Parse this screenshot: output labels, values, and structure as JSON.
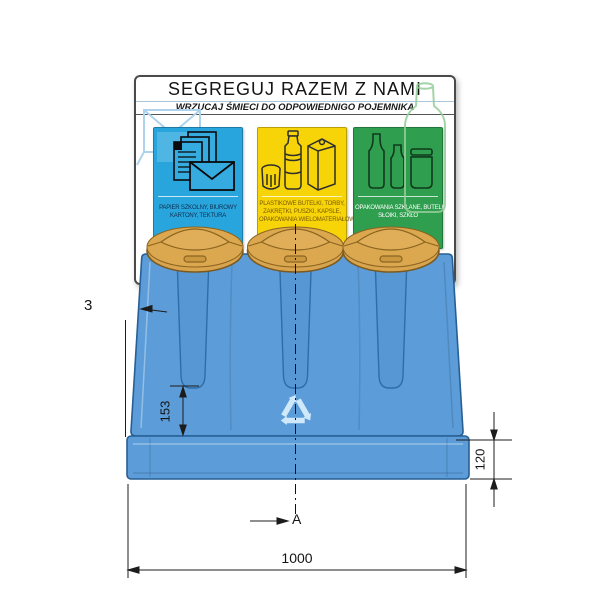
{
  "signboard": {
    "title": "SEGREGUJ RAZEM Z NAMI",
    "subtitle": "WRZUCAJ ŚMIECI DO ODPOWIEDNIGO POJEMNIKA",
    "panels": [
      {
        "name": "paper",
        "color": "#29a5dd",
        "icon": "paper-and-envelope-icon",
        "caption_lines": [
          "PAPIER SZKOLNY, BIUROWY",
          "KARTONY, TEKTURA"
        ]
      },
      {
        "name": "plastic",
        "color": "#f7d408",
        "icon": "plastic-bottle-can-carton-icon",
        "caption_lines": [
          "PLASTIKOWE BUTELKI, TORBY,",
          "ZAKRĘTKI, PUSZKI, KAPSLE,",
          "OPAKOWANIA WIELOMATERIAŁOWE"
        ]
      },
      {
        "name": "glass",
        "color": "#2f9e4f",
        "icon": "glass-bottles-jar-icon",
        "caption_lines": [
          "OPAKOWANIA SZKLANE, BUTELKI",
          "SŁOIKI, SZKŁO"
        ]
      }
    ]
  },
  "dimensions": {
    "wall_label": "3",
    "groove_height": "153",
    "base_height": "120",
    "total_width": "1000",
    "section_label": "A"
  },
  "colors": {
    "bin_body": "#5b9cd9",
    "bin_outline": "#275f94",
    "lid": "#d9a44e",
    "recycle_symbol": "#cfe9fa",
    "panel_paper": "#29a5dd",
    "panel_plastic": "#f7d408",
    "panel_glass": "#2f9e4f"
  }
}
